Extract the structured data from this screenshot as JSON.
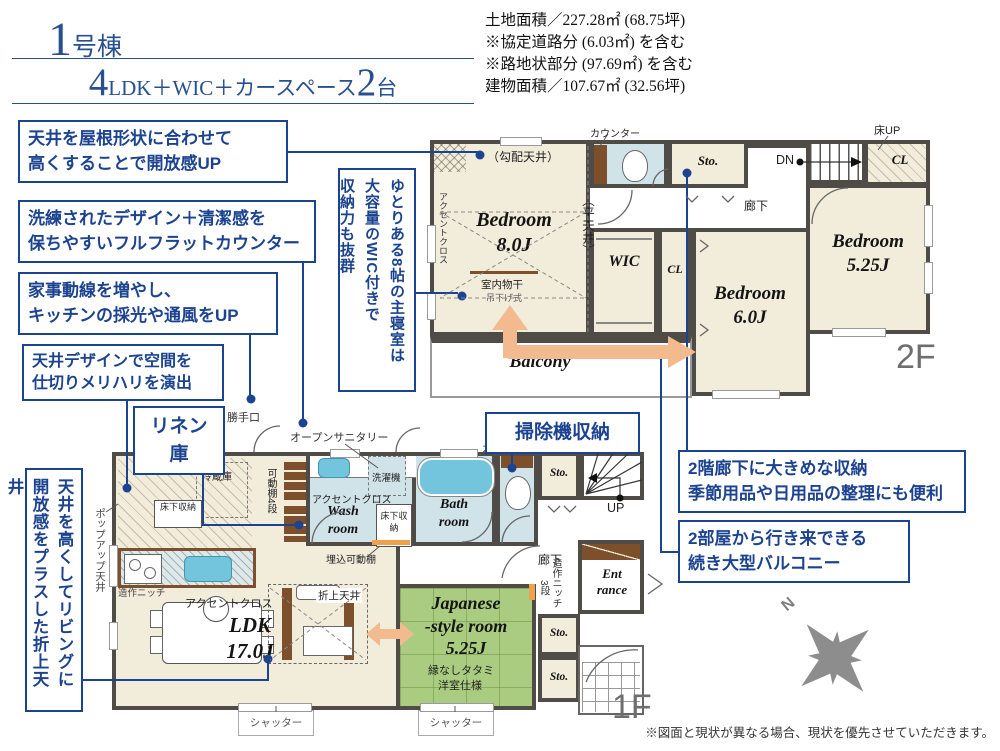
{
  "colors": {
    "navy": "#1c4390",
    "wall": "#4f4b47",
    "cream": "#f2ecdb",
    "room_blue": "#cfe3e9",
    "tatami_green": "#a9cc80",
    "arrow_orange": "#f3ba90",
    "wood_brown": "#7d4f2b",
    "tag_gray": "#6e6e6e"
  },
  "header": {
    "building_number": "1",
    "building_suffix": "号棟",
    "plan_big1": "4",
    "plan_mid": "LDK＋WIC＋カースペース",
    "plan_big2": "2",
    "plan_unit": "台"
  },
  "site_info": {
    "line1": "土地面積／227.28㎡ (68.75坪)",
    "line2": "※協定道路分 (6.03㎡) を含む",
    "line3": "※路地状部分 (97.69㎡) を含む",
    "line4": "建物面積／107.67㎡ (32.56坪)"
  },
  "callouts": {
    "roof": {
      "line1": "天井を屋根形状に合わせて",
      "line2": "高くすることで開放感UP"
    },
    "counter": {
      "line1": "洗練されたデザイン＋清潔感を",
      "line2": "保ちやすいフルフラットカウンター"
    },
    "housework": {
      "line1": "家事動線を増やし、",
      "line2": "キッチンの採光や通風をUP"
    },
    "ceiling": {
      "line1": "天井デザインで空間を",
      "line2": "仕切りメリハリを演出"
    },
    "linen": "リネン庫",
    "vacuum": "掃除機収納",
    "hall_storage": {
      "line1": "2階廊下に大きめな収納",
      "line2": "季節用品や日用品の整理にも便利"
    },
    "balcony": {
      "line1": "2部屋から行き来できる",
      "line2": "続き大型バルコニー"
    },
    "master": {
      "col1": "ゆとりある8帖の主寝室は",
      "col2": "大容量のWIC付きで",
      "col3": "収納力も抜群"
    },
    "living": {
      "col1": "天井を高くしてリビングに",
      "col2": "開放感をプラスした折上天井"
    }
  },
  "floor2": {
    "tag": "2F",
    "bedroom8_name": "Bedroom",
    "bedroom8_size": "8.0J",
    "bedroom6_name": "Bedroom",
    "bedroom6_size": "6.0J",
    "bedroom525_name": "Bedroom",
    "bedroom525_size": "5.25J",
    "wic": "WIC",
    "cl": "CL",
    "cl_top": "CL",
    "sto": "Sto.",
    "balcony": "Balcony",
    "corridor": "廊下",
    "dn": "DN",
    "floor_up": "床UP",
    "counter": "カウンター",
    "slope_ceiling": "（勾配天井）",
    "flat_ceiling": "（平天井）",
    "accent": "アクセントクロス",
    "drying": "室内物干",
    "drying_sub": "吊下げ式"
  },
  "floor1": {
    "tag": "1F",
    "ldk_name": "LDK",
    "ldk_size": "17.0J",
    "jp_line1": "Japanese",
    "jp_line2": "-style room",
    "jp_size": "5.25J",
    "jp_sub1": "縁なしタタミ",
    "jp_sub2": "洋室仕様",
    "wash_line1": "Wash",
    "wash_line2": "room",
    "bath_line1": "Bath",
    "bath_line2": "room",
    "ent_line1": "Ent",
    "ent_line2": "rance",
    "sto": "Sto.",
    "up": "UP",
    "corridor": "廊下",
    "counter": "カウンター",
    "fridge": "冷蔵庫",
    "underfloor": "床下収納",
    "underfloor2": "床下収納",
    "shelf": "可動棚4段",
    "accent_kitchen": "アクセントクロス",
    "accent_wash": "アクセントクロス",
    "open_sanitary": "オープンサニタリー",
    "back_door": "勝手口",
    "washer": "洗濯機",
    "built_in_shelf": "埋込可動棚",
    "niche_kitchen": "造作ニッチ",
    "niche_hall": "造作ニッチ",
    "niche_steps": "3段",
    "coffered": "折上天井",
    "popup": "ポップアップ天井",
    "shutter1": "シャッター",
    "shutter2": "シャッター"
  },
  "compass": {
    "north": "N"
  },
  "footer": {
    "note": "※図面と現状が異なる場合、現状を優先させていただきます。"
  }
}
